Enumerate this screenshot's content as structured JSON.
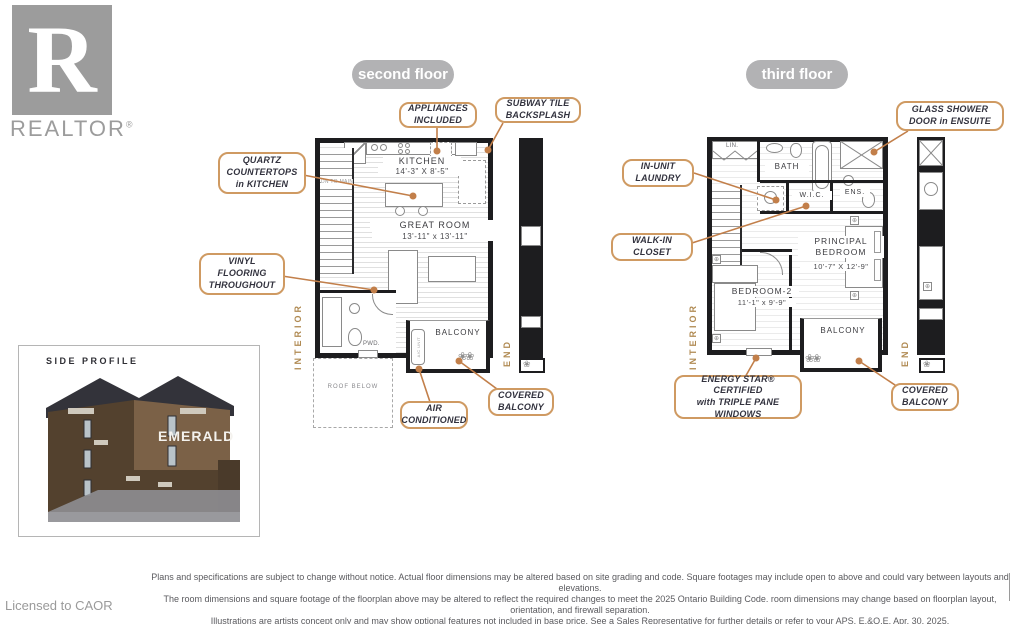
{
  "branding": {
    "logo_r": "R",
    "logo_word": "REALTOR",
    "reg": "®",
    "licensed_to": "Licensed to CAOR"
  },
  "badges": {
    "second": "second floor",
    "third": "third floor"
  },
  "second_floor": {
    "rooms": {
      "kitchen_name": "KITCHEN",
      "kitchen_dims": "14'-3\" X 8'-5\"",
      "great_room_name": "GREAT ROOM",
      "great_room_dims": "13'-11\" x 13'-11\"",
      "balcony": "BALCONY",
      "pwd": "PWD.",
      "roof_below": "ROOF BELOW",
      "interior_label": "INTERIOR",
      "end_label": "END",
      "stairs_note": "DN TO MAIN",
      "ac_unit": "A/C UNIT"
    },
    "callouts": {
      "appliances": "APPLIANCES\nINCLUDED",
      "subway": "SUBWAY TILE\nBACKSPLASH",
      "quartz": "QUARTZ\nCOUNTERTOPS\nin KITCHEN",
      "vinyl": "VINYL\nFLOORING\nTHROUGHOUT",
      "air": "AIR\nCONDITIONED",
      "covered_balcony": "COVERED\nBALCONY"
    }
  },
  "third_floor": {
    "rooms": {
      "lin": "LIN.",
      "bath": "BATH",
      "wic": "W.I.C.",
      "ens": "ENS.",
      "principal_name": "PRINCIPAL\nBEDROOM",
      "principal_dims": "10'-7\" X 12'-9\"",
      "bedroom2_name": "BEDROOM-2",
      "bedroom2_dims": "11'-1\" x 9'-9\"",
      "balcony": "BALCONY",
      "interior_label": "INTERIOR",
      "end_label": "END"
    },
    "callouts": {
      "glass_shower": "GLASS SHOWER\nDOOR in ENSUITE",
      "laundry": "IN-UNIT\nLAUNDRY",
      "walkin": "WALK-IN\nCLOSET",
      "energy": "ENERGY STAR® CERTIFIED\nwith TRIPLE PANE\nWINDOWS",
      "covered_balcony": "COVERED\nBALCONY"
    }
  },
  "side_profile": {
    "title": "SIDE PROFILE",
    "building_name": "EMERALD"
  },
  "disclaimer": {
    "line1": "Plans and specifications are subject to change without notice. Actual floor dimensions may be altered based on site grading and code. Square footages may include open to above and could vary between layouts and elevations.",
    "line2": "The room dimensions and square footage of the floorplan above may be altered to reflect the required changes to meet the 2025 Ontario Building Code. room dimensions may change based on floorplan layout, orientation, and firewall separation.",
    "line3": "Illustrations are artists concept only and may show optional features not included in base price. See a Sales Representative for further details or refer to your APS. E.&O.E. Apr. 30, 2025."
  },
  "icons": {
    "plant": "❀",
    "plants": "❀❀",
    "corner_marker": "⊕"
  },
  "colors": {
    "accent": "#c27f4a",
    "callout_border": "#cf9a62",
    "badge_gray": "#b2b2b4",
    "wall": "#1d1d1f",
    "logo_gray": "#9c9c9c"
  }
}
